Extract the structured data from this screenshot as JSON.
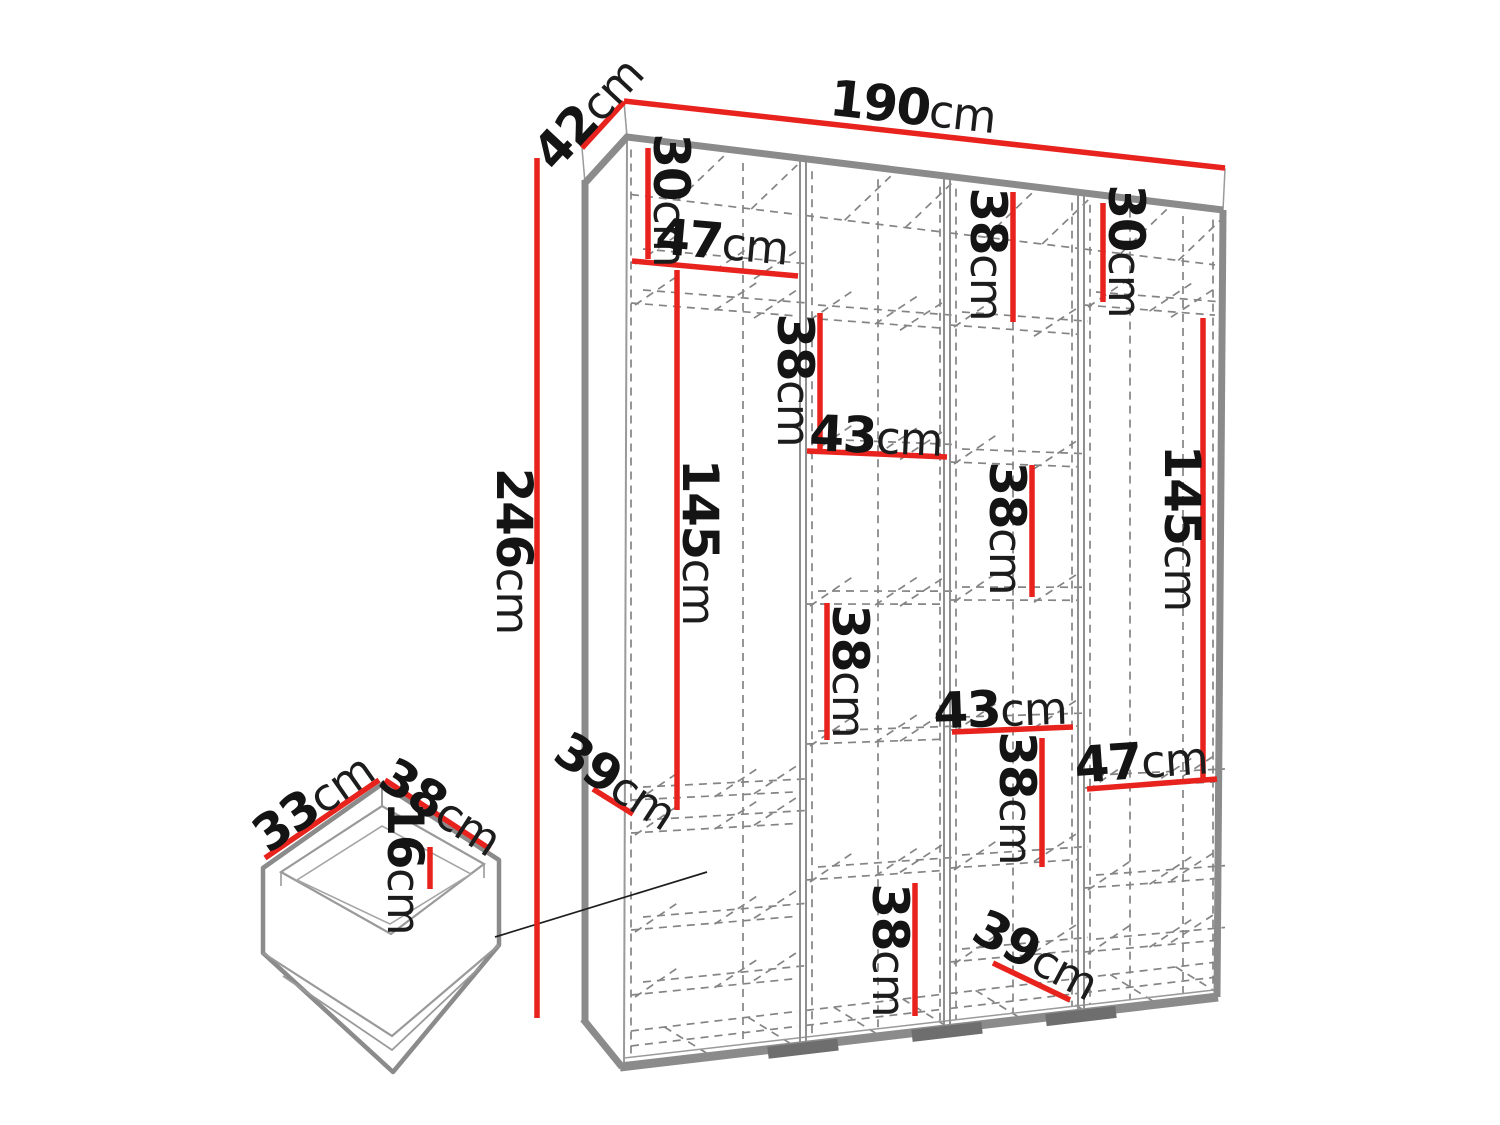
{
  "figure": {
    "type": "furniture-dimension-diagram",
    "subject": "wardrobe-with-internal-shelves-and-drawer",
    "unit": "cm"
  },
  "overall_dimensions": {
    "width": "190cm",
    "depth": "42cm",
    "height": "246cm"
  },
  "drawer_dimensions": {
    "depth": "33cm",
    "width": "38cm",
    "height": "16cm"
  },
  "colors": {
    "dimension_line": "#e8231e",
    "structure_gray": "#8b8b8b",
    "dashed_gray": "#848484",
    "text": "#141414",
    "background": "#ffffff"
  },
  "dim_labels": [
    {
      "id": "overall-width",
      "value": "190",
      "unit": "cm"
    },
    {
      "id": "overall-depth",
      "value": "42",
      "unit": "cm"
    },
    {
      "id": "overall-height",
      "value": "246",
      "unit": "cm"
    },
    {
      "id": "col1-top-height",
      "value": "30",
      "unit": "cm"
    },
    {
      "id": "col1-shelf-width",
      "value": "47",
      "unit": "cm"
    },
    {
      "id": "col1-hanging-height",
      "value": "145",
      "unit": "cm"
    },
    {
      "id": "col1-shelf-depth",
      "value": "39",
      "unit": "cm"
    },
    {
      "id": "col2-top-height",
      "value": "38",
      "unit": "cm"
    },
    {
      "id": "col2-shelf-width",
      "value": "43",
      "unit": "cm"
    },
    {
      "id": "col2-mid-height",
      "value": "38",
      "unit": "cm"
    },
    {
      "id": "col2-bottom-height",
      "value": "38",
      "unit": "cm"
    },
    {
      "id": "col3-top-height",
      "value": "38",
      "unit": "cm"
    },
    {
      "id": "col3-mid-height",
      "value": "38",
      "unit": "cm"
    },
    {
      "id": "col3-shelf-width",
      "value": "43",
      "unit": "cm"
    },
    {
      "id": "col3-lower-height",
      "value": "38",
      "unit": "cm"
    },
    {
      "id": "col3-shelf-depth",
      "value": "39",
      "unit": "cm"
    },
    {
      "id": "col4-top-height",
      "value": "30",
      "unit": "cm"
    },
    {
      "id": "col4-hanging-height",
      "value": "145",
      "unit": "cm"
    },
    {
      "id": "col4-shelf-width",
      "value": "47",
      "unit": "cm"
    },
    {
      "id": "drawer-depth",
      "value": "33",
      "unit": "cm"
    },
    {
      "id": "drawer-width",
      "value": "38",
      "unit": "cm"
    },
    {
      "id": "drawer-height",
      "value": "16",
      "unit": "cm"
    }
  ]
}
